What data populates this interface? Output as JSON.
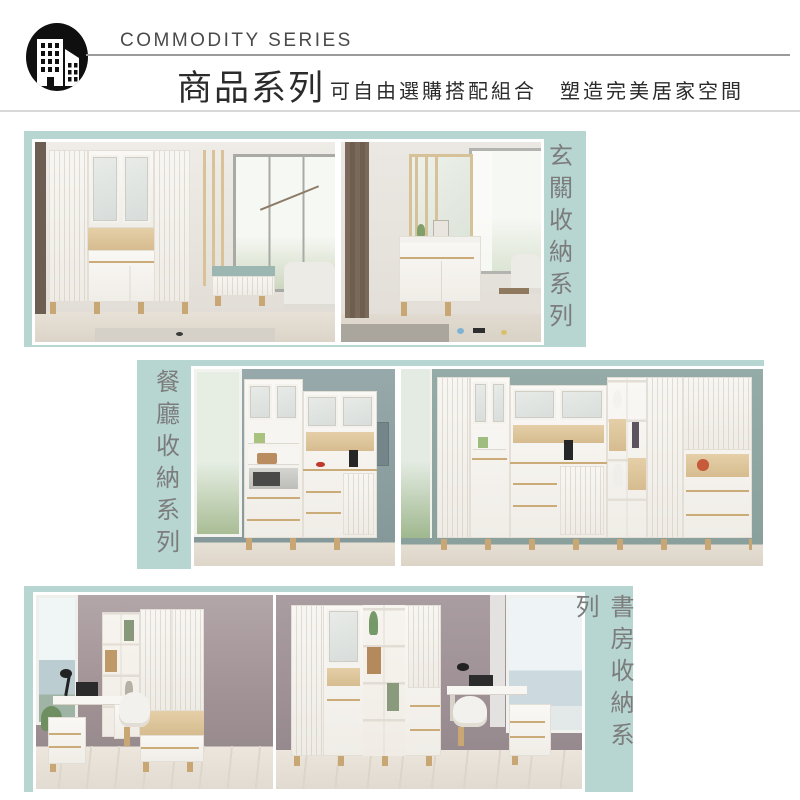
{
  "header": {
    "logo_icon": "buildings-in-circle-icon",
    "title_en": "COMMODITY SERIES",
    "title_zh": "商品系列",
    "subtitle": "可自由選購搭配組合　塑造完美居家空間"
  },
  "sections": [
    {
      "label": "玄關收納系列",
      "label_side": "right",
      "photo_count": 2,
      "photo_theme": "entryway shoe cabinets and divider screens"
    },
    {
      "label": "餐廳收納系列",
      "label_side": "left",
      "photo_count": 2,
      "photo_theme": "dining room hutch and sideboard storage"
    },
    {
      "label": "書房收納系列",
      "label_side": "right",
      "photo_count": 2,
      "photo_theme": "study room bookcases and desks"
    }
  ],
  "colors": {
    "panel_teal": "#b7d6d2",
    "label_gray": "#7c7c7c",
    "heading_dark": "#2b2b2b",
    "header_rule": "#9b9b9b",
    "divider_gray": "#d8d8d8",
    "wood_accent": "#cbab77"
  }
}
